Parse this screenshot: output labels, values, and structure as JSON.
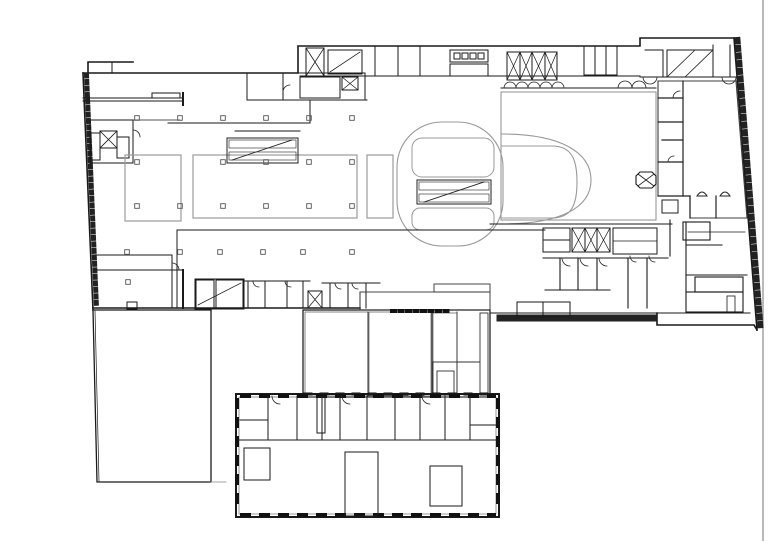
{
  "document": {
    "type": "architectural-floor-plan",
    "description": "Black-and-white shopping centre level plan with one tenancy highlighted in pink at upper right"
  },
  "canvas": {
    "width": 768,
    "height": 541,
    "background": "#ffffff"
  },
  "colors": {
    "wall": "#1f1f1f",
    "secondary_line": "#999999",
    "hatch": "#444444",
    "highlight_fill": "#F85091",
    "highlight_stroke": "#3c3c3c",
    "sheet_border": "#8c8c8c"
  },
  "highlight": {
    "region": "upper-right-tenancy"
  }
}
